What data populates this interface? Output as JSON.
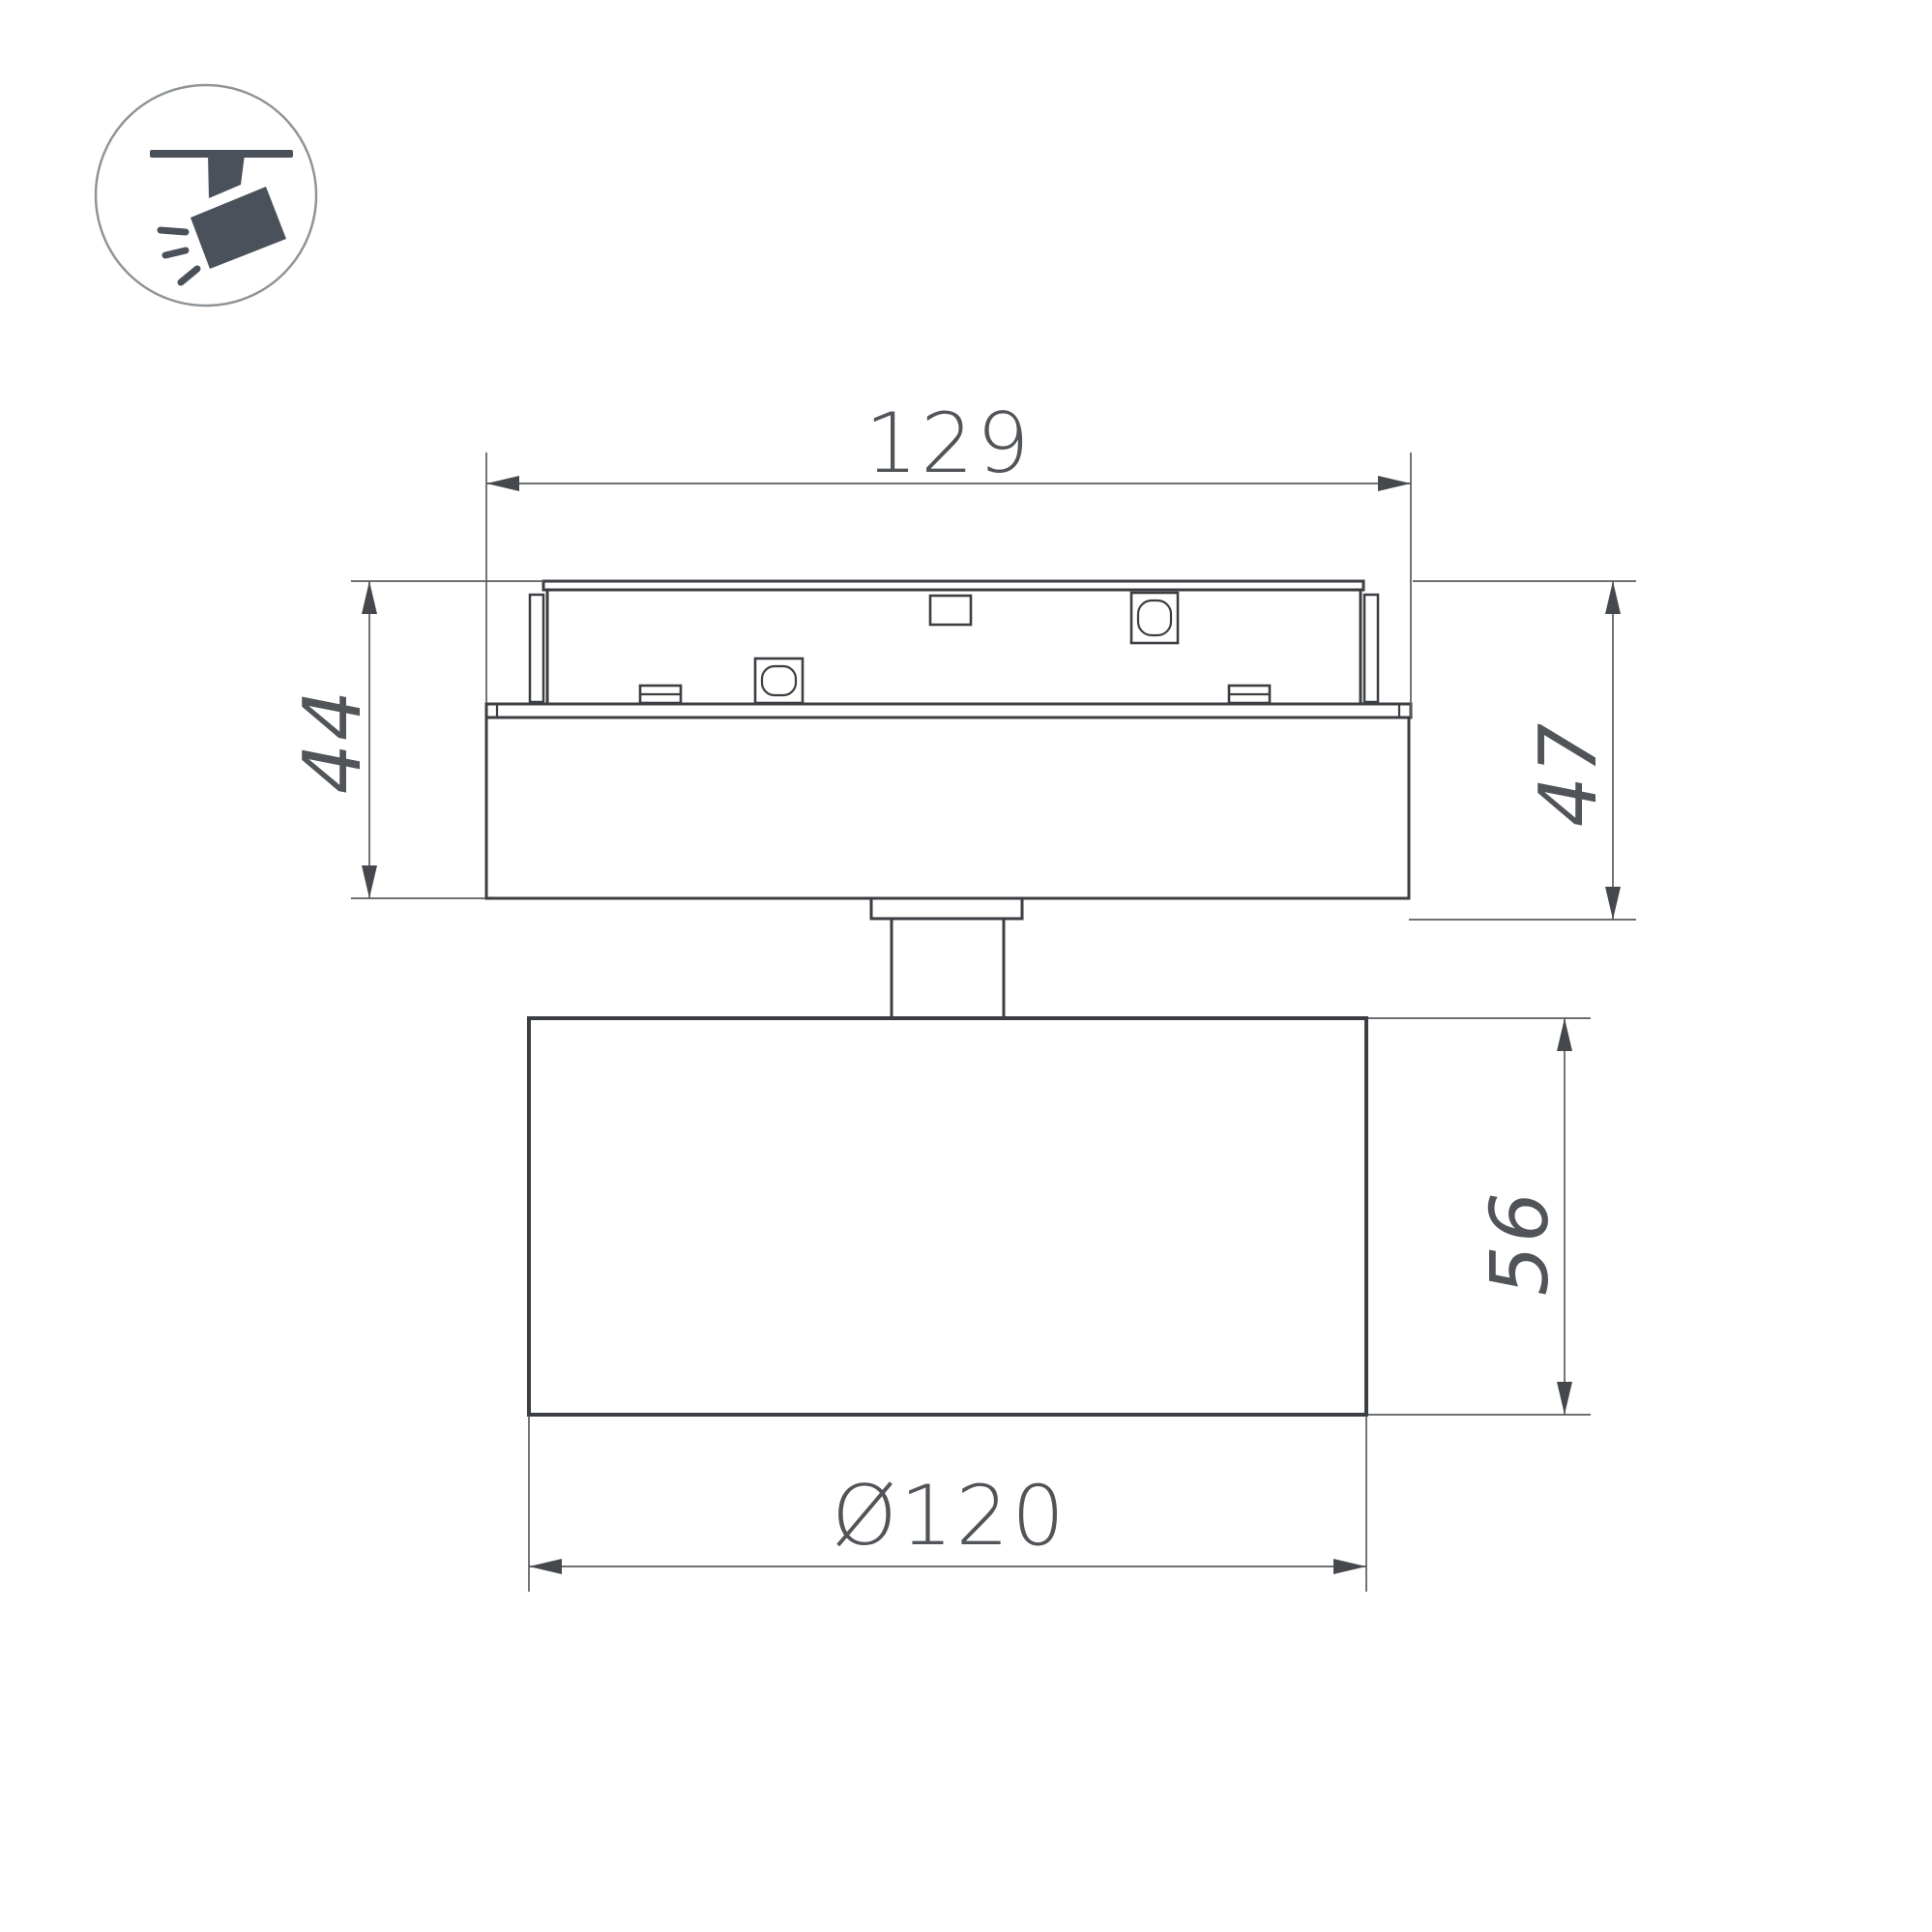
{
  "drawing": {
    "title": "track-spotlight-dimension-drawing",
    "dims": {
      "track_width": "129",
      "adapter_height": "44",
      "overall_height": "47",
      "head_height": "56",
      "head_diameter": "Ø120"
    },
    "icon": {
      "name": "track-spotlight-icon"
    },
    "colors": {
      "outline": "#3b3e42",
      "dimension_line": "#595c60",
      "dimension_text": "#515458",
      "icon_glyph": "#4a515a",
      "icon_circle": "#8f9498",
      "background": "#ffffff"
    }
  }
}
